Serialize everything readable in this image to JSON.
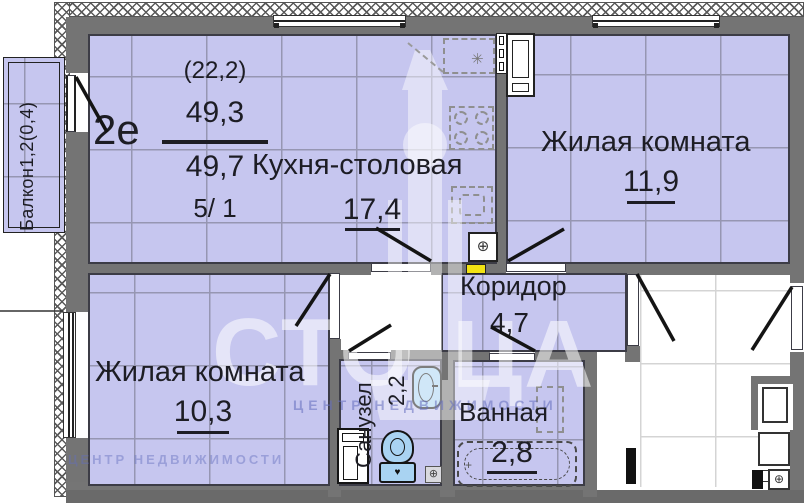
{
  "plan_title": "2е",
  "stats": {
    "kitchen_living_sum": "(22,2)",
    "living_area": "49,3",
    "total_area": "49,7",
    "floor": "5/ 1"
  },
  "rooms": {
    "kitchen": {
      "label": "Кухня-столовая",
      "area": "17,4"
    },
    "living_room_1": {
      "label": "Жилая комната",
      "area": "11,9"
    },
    "living_room_2": {
      "label": "Жилая комната",
      "area": "10,3"
    },
    "corridor": {
      "label": "Коридор",
      "area": "4,7"
    },
    "wc": {
      "label": "Санузел",
      "area": "2,2"
    },
    "bathroom": {
      "label": "Ванная",
      "area": "2,8"
    },
    "balcony": {
      "label": "Балкон1,2(0,4)"
    }
  },
  "icons": {
    "asterisk": "✳",
    "vent": "⊕",
    "heart": "♥",
    "plus": "+"
  },
  "watermark": {
    "part_left": "СТО",
    "part_right": "ЦА",
    "sub": "ЦЕНТР НЕДВИЖИМОСТИ"
  },
  "colors": {
    "room_fill": "#c6c6ef",
    "wall": "#747474",
    "fixture_blue": "#a9d3f2",
    "panel_yellow": "#f2e313",
    "outline": "#3c3c46"
  }
}
